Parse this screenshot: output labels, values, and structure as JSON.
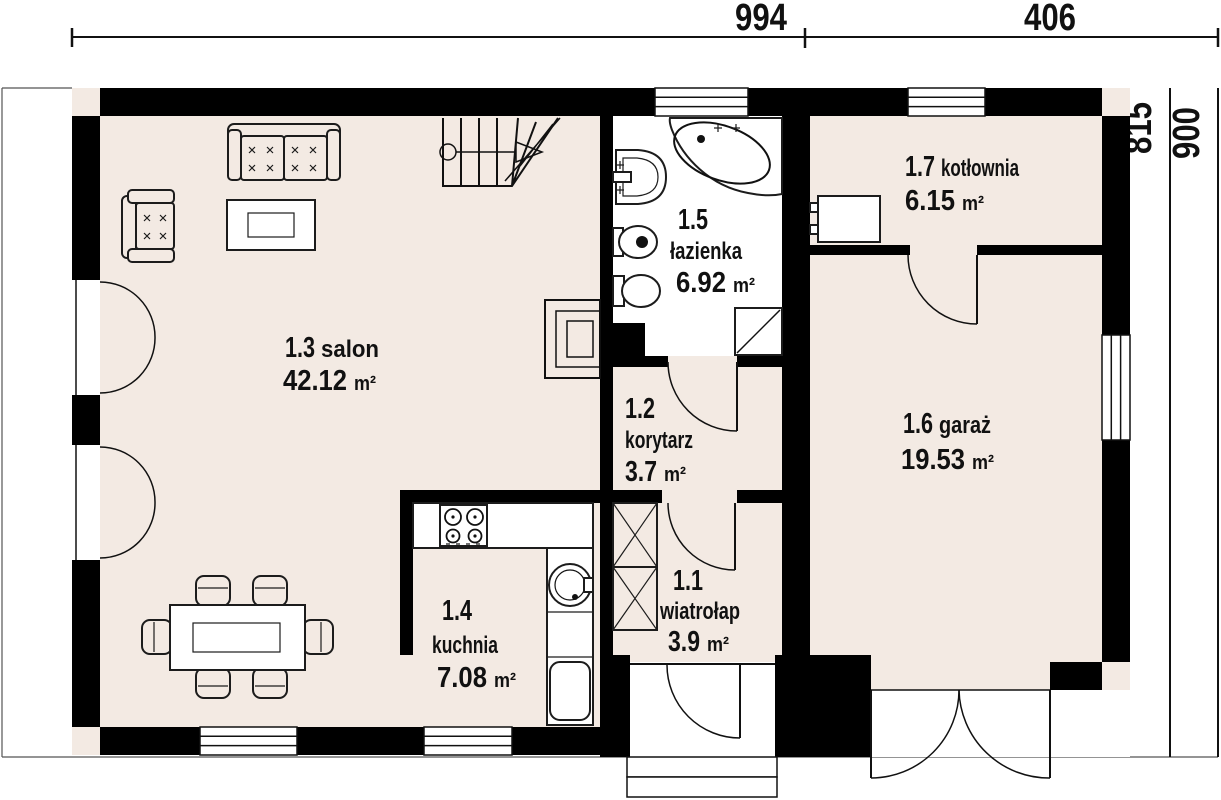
{
  "dimensions": {
    "top": [
      "994",
      "406"
    ],
    "right": [
      "815",
      "900"
    ]
  },
  "rooms": {
    "wiatrolap": {
      "number": "1.1",
      "name": "wiatrołap",
      "area": "3.9",
      "unit": "m²"
    },
    "korytarz": {
      "number": "1.2",
      "name": "korytarz",
      "area": "3.7",
      "unit": "m²"
    },
    "salon": {
      "number": "1.3",
      "name": "salon",
      "area": "42.12",
      "unit": "m²"
    },
    "kuchnia": {
      "number": "1.4",
      "name": "kuchnia",
      "area": "7.08",
      "unit": "m²"
    },
    "lazienka": {
      "number": "1.5",
      "name": "łazienka",
      "area": "6.92",
      "unit": "m²"
    },
    "garaz": {
      "number": "1.6",
      "name": "garaż",
      "area": "19.53",
      "unit": "m²"
    },
    "kotlownia": {
      "number": "1.7",
      "name": "kotłownia",
      "area": "6.15",
      "unit": "m²"
    }
  },
  "colors": {
    "wall": "#000000",
    "floor": "#f3eae3",
    "bathroom_floor": "#ffffff",
    "line": "#1c1c1c",
    "background": "#ffffff"
  },
  "symbols": [
    "stairs",
    "sofa",
    "armchair",
    "coffee-table",
    "fireplace",
    "dining-table",
    "chair",
    "kitchen-counter",
    "stove",
    "kitchen-sink",
    "fridge",
    "wardrobe",
    "corner-bathtub",
    "washbasin",
    "bidet",
    "toilet",
    "shower",
    "boiler",
    "door-swing",
    "window",
    "entry-steps"
  ]
}
